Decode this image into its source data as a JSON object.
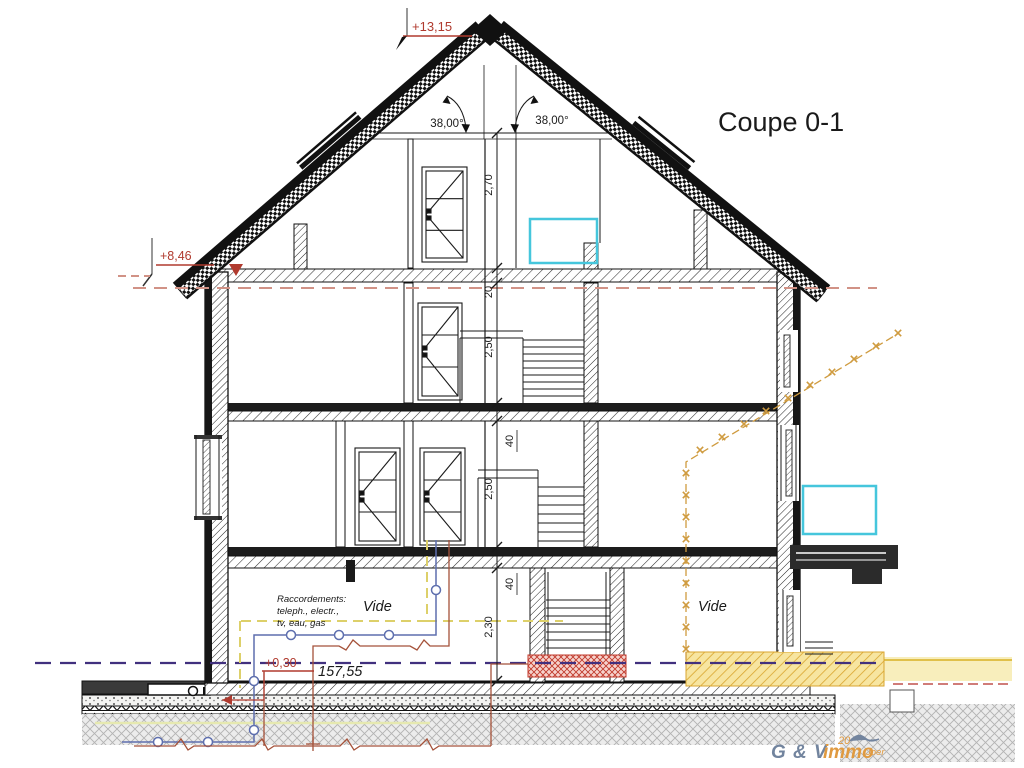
{
  "title": "Coupe 0-1",
  "levels": {
    "ridge": "+13,15",
    "eave": "+8,46",
    "ground": "+0,30",
    "altitude": "157,55"
  },
  "angles": {
    "left": "38,00°",
    "right": "38,00°"
  },
  "dimensions": {
    "attic_height": "2,70",
    "attic_slab": "20",
    "floor2_height": "2,50",
    "slab2_thickness": "40",
    "floor1_height": "2,50",
    "slab1_thickness": "40",
    "basement_height": "2,30"
  },
  "labels": {
    "vide_left": "Vide",
    "vide_right": "Vide",
    "raccordements_line1": "Raccordements:",
    "raccordements_line2": "teleph., electr.,",
    "raccordements_line3": "tv, eau, gas"
  },
  "logo": {
    "gv": "G & V",
    "immo": "immo",
    "years": "20",
    "joer": "Joer"
  },
  "colors": {
    "marker_red": "#b03a2e",
    "level_salmon": "#d19286",
    "boundary_purple": "#41307e",
    "utility_blue": "#5e6fae",
    "utility_red": "#a5523a",
    "utility_yellow": "#ddd06a",
    "limit_orange": "#cf9b3f",
    "window_cyan": "#45c6dc",
    "logo_blue": "#72849e",
    "logo_orange": "#e09a40"
  }
}
